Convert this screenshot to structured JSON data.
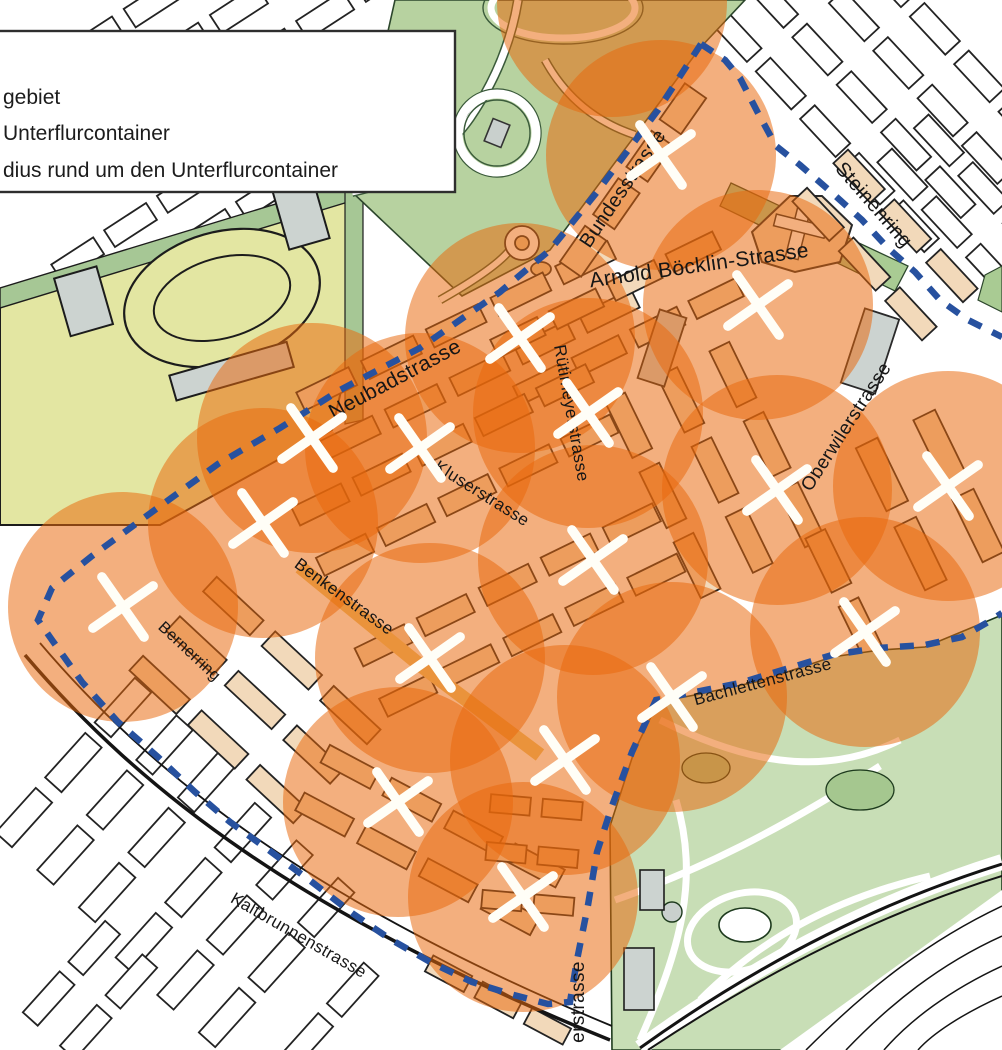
{
  "legend": {
    "items": [
      {
        "label": "gebiet"
      },
      {
        "label": "Unterflurcontainer"
      },
      {
        "label": "dius rund um den Unterflurcontainer"
      }
    ]
  },
  "map": {
    "streets": [
      {
        "name": "Bundesstrasse",
        "x": 628,
        "y": 192,
        "rotate": -56,
        "size": 20
      },
      {
        "name": "Steinenring",
        "x": 869,
        "y": 209,
        "rotate": 49,
        "size": 20
      },
      {
        "name": "Arnold Böcklin-Strasse",
        "x": 700,
        "y": 272,
        "rotate": -8,
        "size": 21
      },
      {
        "name": "Neubadstrasse",
        "x": 398,
        "y": 385,
        "rotate": -28,
        "size": 21
      },
      {
        "name": "Rütimeyerstrasse",
        "x": 566,
        "y": 414,
        "rotate": 80,
        "size": 17
      },
      {
        "name": "Kluserstrasse",
        "x": 479,
        "y": 498,
        "rotate": 32,
        "size": 17
      },
      {
        "name": "Oberwilerstrasse",
        "x": 851,
        "y": 430,
        "rotate": -57,
        "size": 19
      },
      {
        "name": "Benkenstrasse",
        "x": 341,
        "y": 601,
        "rotate": 36,
        "size": 17
      },
      {
        "name": "Bernerring",
        "x": 186,
        "y": 655,
        "rotate": 43,
        "size": 16
      },
      {
        "name": "Bachlettenstrasse",
        "x": 764,
        "y": 687,
        "rotate": -15,
        "size": 17
      },
      {
        "name": "Kaltbrunnenstrasse",
        "x": 296,
        "y": 940,
        "rotate": 30,
        "size": 17
      },
      {
        "name": "erstrasse",
        "x": 584,
        "y": 1002,
        "rotate": -90,
        "size": 19
      }
    ],
    "containers": [
      {
        "x": 661,
        "y": 155
      },
      {
        "x": 758,
        "y": 305
      },
      {
        "x": 520,
        "y": 338
      },
      {
        "x": 588,
        "y": 413
      },
      {
        "x": 312,
        "y": 438
      },
      {
        "x": 420,
        "y": 448
      },
      {
        "x": 948,
        "y": 486
      },
      {
        "x": 777,
        "y": 490
      },
      {
        "x": 263,
        "y": 523
      },
      {
        "x": 593,
        "y": 560
      },
      {
        "x": 123,
        "y": 607
      },
      {
        "x": 865,
        "y": 632
      },
      {
        "x": 430,
        "y": 658
      },
      {
        "x": 672,
        "y": 697
      },
      {
        "x": 565,
        "y": 760
      },
      {
        "x": 398,
        "y": 802
      },
      {
        "x": 523,
        "y": 897
      }
    ],
    "extra_circles": [
      {
        "x": 612,
        "y": 2
      }
    ],
    "circle_radius_px": 115,
    "boundary_main_points": [
      [
        701,
        44
      ],
      [
        658,
        110
      ],
      [
        597,
        192
      ],
      [
        550,
        250
      ],
      [
        500,
        292
      ],
      [
        420,
        348
      ],
      [
        340,
        390
      ],
      [
        280,
        428
      ],
      [
        218,
        464
      ],
      [
        152,
        512
      ],
      [
        92,
        556
      ],
      [
        52,
        588
      ],
      [
        38,
        620
      ],
      [
        52,
        640
      ],
      [
        82,
        682
      ],
      [
        118,
        722
      ],
      [
        158,
        757
      ],
      [
        195,
        792
      ],
      [
        230,
        822
      ],
      [
        270,
        851
      ],
      [
        312,
        882
      ],
      [
        352,
        913
      ],
      [
        390,
        939
      ],
      [
        432,
        963
      ],
      [
        472,
        982
      ],
      [
        510,
        994
      ],
      [
        548,
        1004
      ],
      [
        570,
        1002
      ],
      [
        577,
        960
      ],
      [
        588,
        905
      ],
      [
        597,
        852
      ],
      [
        612,
        806
      ],
      [
        632,
        752
      ],
      [
        656,
        700
      ],
      [
        690,
        693
      ],
      [
        740,
        683
      ],
      [
        786,
        669
      ],
      [
        832,
        655
      ],
      [
        878,
        648
      ],
      [
        925,
        645
      ],
      [
        962,
        637
      ],
      [
        988,
        622
      ],
      [
        1002,
        613
      ]
    ],
    "boundary_ne_points": [
      [
        701,
        44
      ],
      [
        725,
        60
      ],
      [
        740,
        78
      ],
      [
        758,
        113
      ],
      [
        776,
        146
      ],
      [
        800,
        165
      ],
      [
        830,
        191
      ],
      [
        862,
        220
      ],
      [
        888,
        248
      ],
      [
        915,
        272
      ],
      [
        940,
        300
      ],
      [
        968,
        320
      ],
      [
        1002,
        337
      ]
    ],
    "colors": {
      "radius_orange": "#e8680c",
      "radius_opacity": 0.53,
      "boundary_blue": "#27519f",
      "marker_white": "#fffef7",
      "park_green": "#b7d2a0",
      "zoo_green": "#c8deb6",
      "field_yellow": "#e3e6a2",
      "strip_green": "#a6c795",
      "building_gray": "#ccd3d0",
      "zone_building_buff": "#f2d9ba",
      "yellow_street": "#ecc372"
    }
  }
}
